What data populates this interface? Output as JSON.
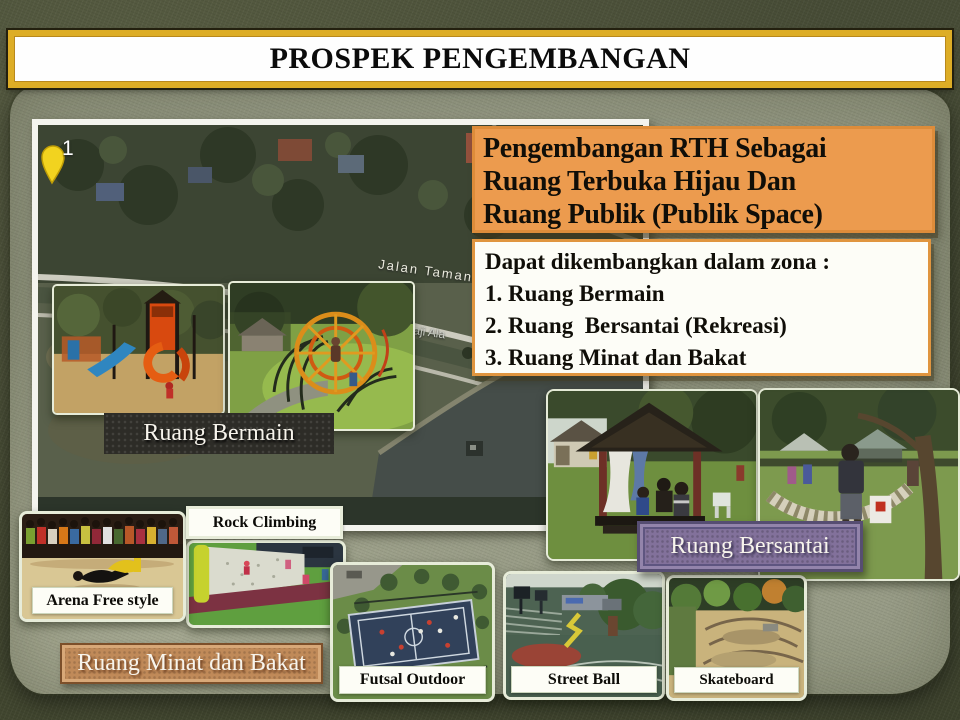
{
  "slide": {
    "title": "PROSPEK PENGEMBANGAN"
  },
  "heading": {
    "lines": [
      "Pengembangan RTH Sebagai",
      "Ruang Terbuka Hijau Dan",
      "Ruang Publik (Publik Space)"
    ]
  },
  "zona": {
    "intro": "Dapat dikembangkan dalam zona :",
    "items": [
      "1. Ruang Bermain",
      "2. Ruang  Bersantai (Rekreasi)",
      "3. Ruang Minat dan Bakat"
    ]
  },
  "map": {
    "marker_label": "1",
    "pin_icon": "map-pin-yellow",
    "street_1": "Jalan Taman",
    "street_2": "Y.Haji Ala"
  },
  "zones": {
    "bermain": "Ruang Bermain",
    "bersantai": "Ruang Bersantai",
    "minat": "Ruang Minat dan Bakat"
  },
  "cards": {
    "arena": "Arena Free style",
    "rock": "Rock Climbing",
    "futsal": "Futsal Outdoor",
    "streetball": "Street Ball",
    "skate": "Skateboard"
  },
  "colors": {
    "banner_gold": "#DDAD26",
    "box_orange": "#EC9B4E",
    "border_orange": "#E0953F",
    "tag_dark": "#2D2C27",
    "tag_purple": "#82719B",
    "tag_copper": "#C08A59",
    "paper_green": "#969A85",
    "background_olive": "#474C36"
  }
}
